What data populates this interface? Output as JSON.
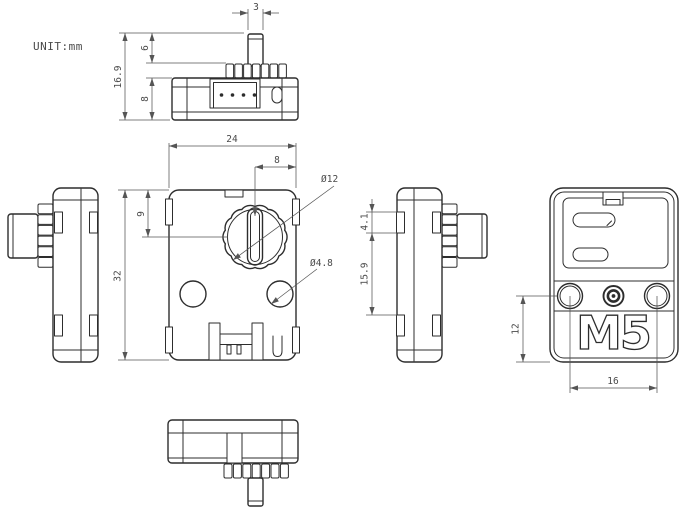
{
  "drawing": {
    "unit_label": "UNIT:mm",
    "logo_text": "M5"
  },
  "dims": {
    "top": {
      "shaft_width": "3",
      "total_height": "16.9",
      "shaft_height": "6",
      "body_height": "8"
    },
    "front": {
      "body_width": "24",
      "knob_center_to_edge": "8",
      "knob_center_from_top": "9",
      "body_height": "32",
      "knob_diameter": "Ø12",
      "hole_diameter": "Ø4.8"
    },
    "side": {
      "clip_height": "4.1",
      "clip_spacing": "15.9"
    },
    "back": {
      "hole_to_bottom": "12",
      "hole_spacing": "16"
    }
  },
  "colors": {
    "line": "#2d2d2d",
    "dimension": "#555555",
    "background": "#ffffff"
  }
}
